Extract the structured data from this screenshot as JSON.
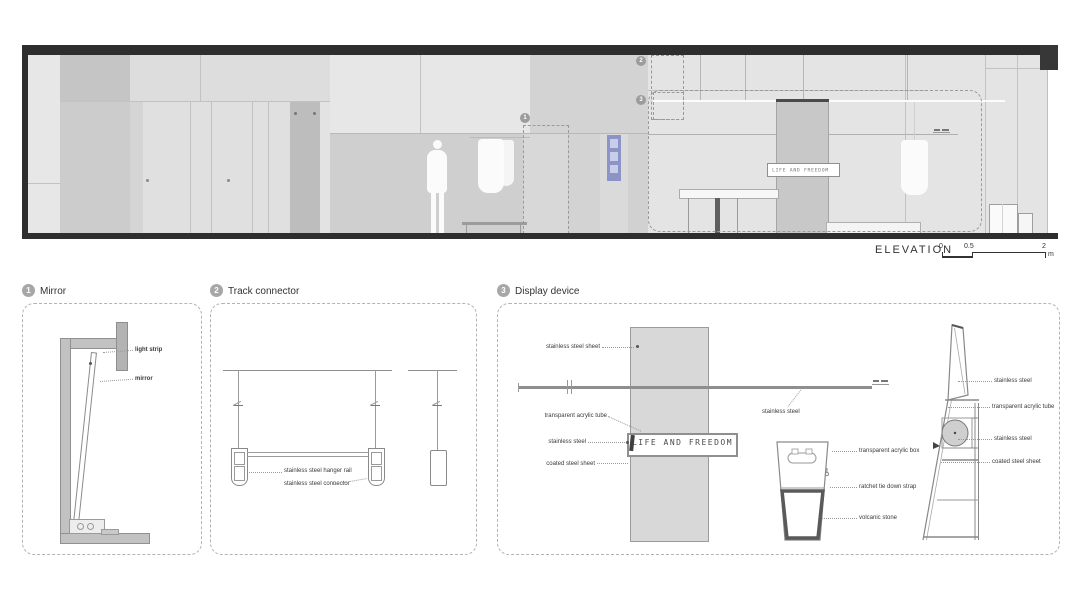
{
  "elevation": {
    "title": "ELEVATION",
    "display_sign": "LIFE AND FREEDOM",
    "scale_ticks": [
      "0",
      "0.5",
      "2"
    ],
    "scale_unit": "m",
    "callouts": [
      "1",
      "2",
      "3"
    ]
  },
  "panels": [
    {
      "num": "1",
      "title": "Mirror",
      "labels": [
        "light strip",
        "mirror"
      ]
    },
    {
      "num": "2",
      "title": "Track connector",
      "labels": [
        "stainless steel hanger rail",
        "stainless steel connector"
      ]
    },
    {
      "num": "3",
      "title": "Display device",
      "sign": "LIFE AND FREEDOM",
      "front_labels": [
        "stainless steel sheet",
        "transparent acrylic tube",
        "stainless steel",
        "coated steel sheet"
      ],
      "rod_label": "stainless steel",
      "stand_labels": [
        "transparent acrylic box",
        "ratchet tie down strap",
        "volcanic stone"
      ],
      "side_labels": [
        "stainless steel",
        "transparent acrylic tube",
        "stainless steel",
        "coated steel sheet"
      ]
    }
  ]
}
